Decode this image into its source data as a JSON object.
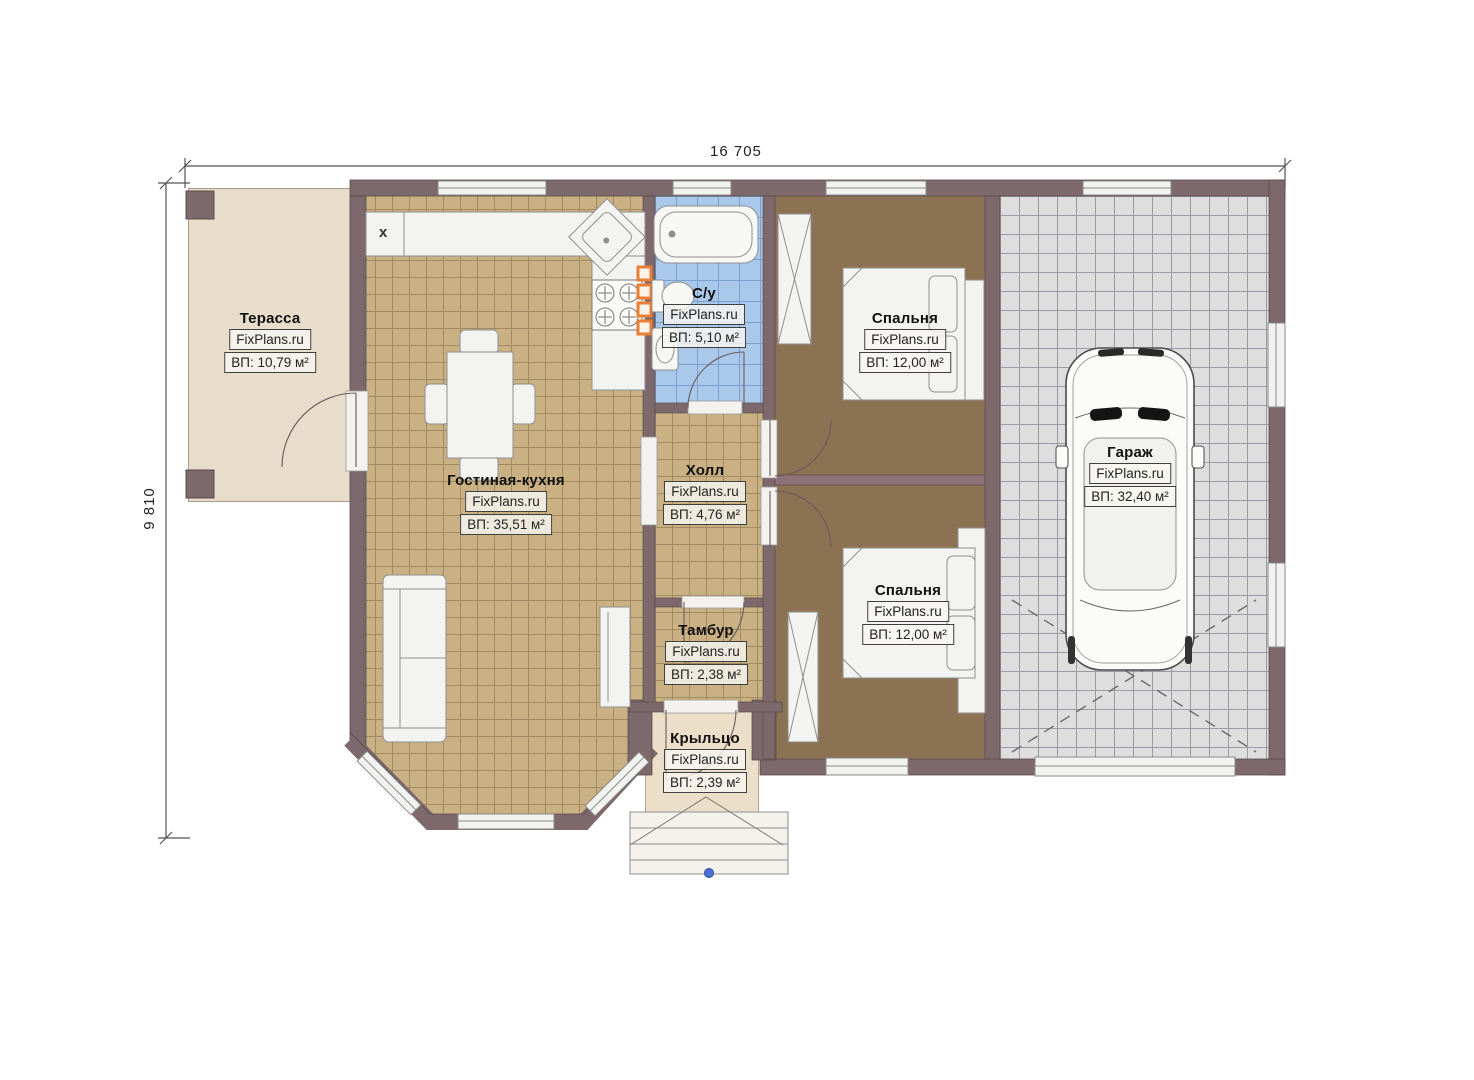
{
  "plan": {
    "dimensions": {
      "width_label": "16 705",
      "height_label": "9 810"
    },
    "markers": {
      "kitchen_x": "x"
    },
    "rooms": [
      {
        "id": "terrace",
        "name": "Терасса",
        "brand": "FixPlans.ru",
        "area": "ВП: 10,79 м²"
      },
      {
        "id": "living",
        "name": "Гостиная-кухня",
        "brand": "FixPlans.ru",
        "area": "ВП: 35,51 м²"
      },
      {
        "id": "bath",
        "name": "С/у",
        "brand": "FixPlans.ru",
        "area": "ВП: 5,10 м²"
      },
      {
        "id": "hall",
        "name": "Холл",
        "brand": "FixPlans.ru",
        "area": "ВП: 4,76 м²"
      },
      {
        "id": "bedroom1",
        "name": "Спальня",
        "brand": "FixPlans.ru",
        "area": "ВП: 12,00 м²"
      },
      {
        "id": "bedroom2",
        "name": "Спальня",
        "brand": "FixPlans.ru",
        "area": "ВП: 12,00 м²"
      },
      {
        "id": "tambour",
        "name": "Тамбур",
        "brand": "FixPlans.ru",
        "area": "ВП: 2,38 м²"
      },
      {
        "id": "porch",
        "name": "Крыльцо",
        "brand": "FixPlans.ru",
        "area": "ВП: 2,39 м²"
      },
      {
        "id": "garage",
        "name": "Гараж",
        "brand": "FixPlans.ru",
        "area": "ВП: 32,40 м²"
      }
    ],
    "colors": {
      "wall": "#7d686b",
      "living_floor": "#c9b183",
      "bedroom_floor": "#8b7252",
      "bath_floor": "#a9c8ea",
      "garage_floor": "#dedede",
      "terrace_floor": "#e8ddca",
      "vent_orange": "#e87f35",
      "stair_dot_blue": "#4a6fd4"
    }
  }
}
